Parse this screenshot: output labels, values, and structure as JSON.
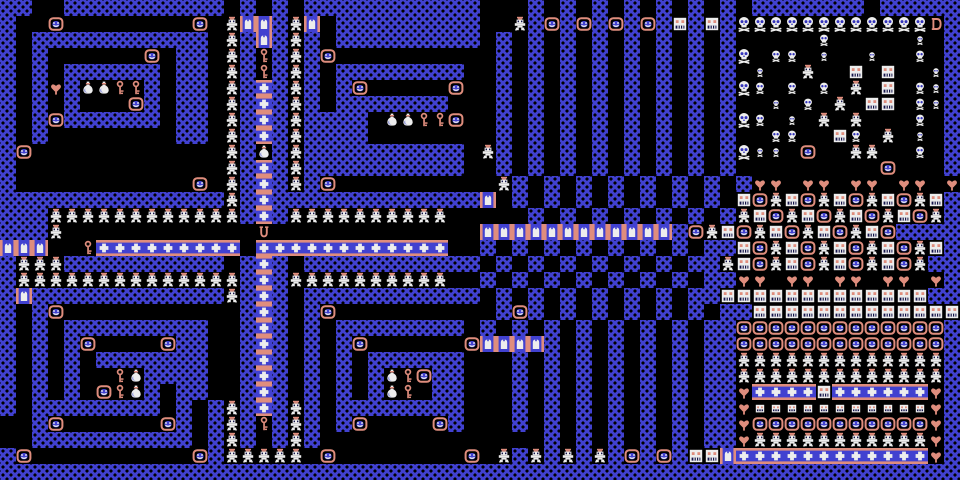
{
  "board": {
    "tile_size": 16,
    "cols": 60,
    "rows": 30,
    "palette": {
      "bg": "#000000",
      "wall": "#4141d0",
      "accent": "#df8d7d",
      "white": "#ededed",
      "eye_blue": "#3333bb",
      "dark": "#14144a",
      "bag_shadow": "#9aa0dc"
    },
    "legend": {
      "#": {
        "name": "wall",
        "class": "w"
      },
      ".": {
        "name": "floor",
        "class": "f"
      },
      "S": {
        "name": "smiley-spawner",
        "sprite": "smiley"
      },
      "g": {
        "name": "ghost",
        "sprite": "ghost"
      },
      "F": {
        "name": "spawner-face",
        "sprite": "face"
      },
      "f": {
        "name": "spawner-face-small",
        "sprite": "face-small"
      },
      "K": {
        "name": "skull-large",
        "sprite": "skull-large"
      },
      "M": {
        "name": "skull-medium",
        "sprite": "skull-medium"
      },
      "k": {
        "name": "skull-small",
        "sprite": "skull-small"
      },
      "h": {
        "name": "heart",
        "sprite": "heart"
      },
      "y": {
        "name": "key",
        "sprite": "key"
      },
      "m": {
        "name": "money-bag",
        "sprite": "money-bag"
      },
      "+": {
        "name": "door-horizontal",
        "sprite": "door-h"
      },
      "D": {
        "name": "door-vertical",
        "sprite": "door-v"
      },
      "E": {
        "name": "exit-door",
        "sprite": "exit"
      },
      "U": {
        "name": "urn",
        "sprite": "urn"
      }
    },
    "grid": [
      "##..##########.#.#.###########...#.#.#.#.#.#.#.#######.#####",
      "#..S........S.gDD#gD.#########..g#S#S#S#S#F#F#KKKKKKKKKKKKE#",
      "#.###########.g#D#g#.#########.#.#.#.#.#.#.#.#.....M.....k.#",
      "#.#......S.##.g#y#g#S..........#.#.#.#.#.#.#.#K.MM.k..k..M.#",
      "#.#.######.##.g#y#g#.########..#.#.#.#.#.#.#.#.k..g..F.F..k#",
      "#.#h#mmyy#.##.g#+#g#.#S.....S..#.#.#.#.#.#.#.#KM.M.M.g.F.Mk#",
      "#.#.#...S#.##.g#+#g#.#######...#.#.#.#.#.#.#.#..k.M.g.FF.Mk#",
      "#.#S######.##.g#+#g####.mmyyS..#.#.#.#.#.#.#.#KM.k.g.g...M.#",
      "#.#........##.g#+#g####........#.#.#.#.#.#.#.#..MM..FM.g.k.#",
      "#S............g#m#g##########.g#.#.#.#.#.#.#.#Kkk.S..gg..M.#",
      "#.............g#+#g##########..#.#.#.#.#.#.#.#.........S...#",
      "#...........S.g#+#g#S..........g#.#.#.#.#.#.#.#hh.hh.hh.hh.h",
      "##############g#+#############D.#.#.#.#.#.#.#.FSgFSgFSgFSgF",
      "###gggggggggggg#+#gggggggggg.....#.#.#.#.#.#.#gFSgFSgFSgFSg",
      "###g............U.............DDDDDDDDDDDD#SgFSgFSgFSgFS#",
      "DDD..y+++++++++.++++++++++++..#.#.#.#.#.#.#.##FSgFSgFSgFSgF",
      "#ggg##########.#+#.###########.#.#.#.#.#.#.##gFSgFSgFSgFSg#",
      "#gggggggggggggg#+#gggggggggg..#.#.#.#.#.#.#.##hh.hh.hh.hh.h",
      "#D############g#+#.###########.#.#.#.#.#.#.##FFFFFFFFFFFFF#",
      "#.#S...........#+#.#S..........#S#.#.#.#.#.#.##FFFFFFFFFFFFF",
      "#.#.#########..#+#.#.########.#.#.#.#.#.#.#.##SSSSSSSSSSSSS",
      "#.#.#S....S##..#+#.#.#S......SDDDD#.#.#.#.#.##SSSSSSSSSSSSS",
      "#.#.#.#######..#+#.#.#.######...#.#.#.#.#.#.##ggggggggggggg",
      "#.#.#..ym####..#+#.#.#.#myS##...#.#.#.#.#.#.##ggggggggggggg",
      "#.#.#.Sym#.##..#+#.#.#.#my.##...#.#.#.#.#.#.##h++++F++++++h",
      "#.########.#.#g#+#g#.########...#.#.#.#.#.#.##hfffffffffffh",
      "..#S......S#.#g#y#g#.#S....S#...#.#.#.#.#.#.##hSSSSSSSSSSSh",
      "..##########.#g#.#g#..............#.#.#.#.#.##hgggggggggggh",
      "#S..........S#ggggg.S........S.g#g#g#g#S#S#FFD++++++++++++h#",
      "############################################################"
    ]
  }
}
